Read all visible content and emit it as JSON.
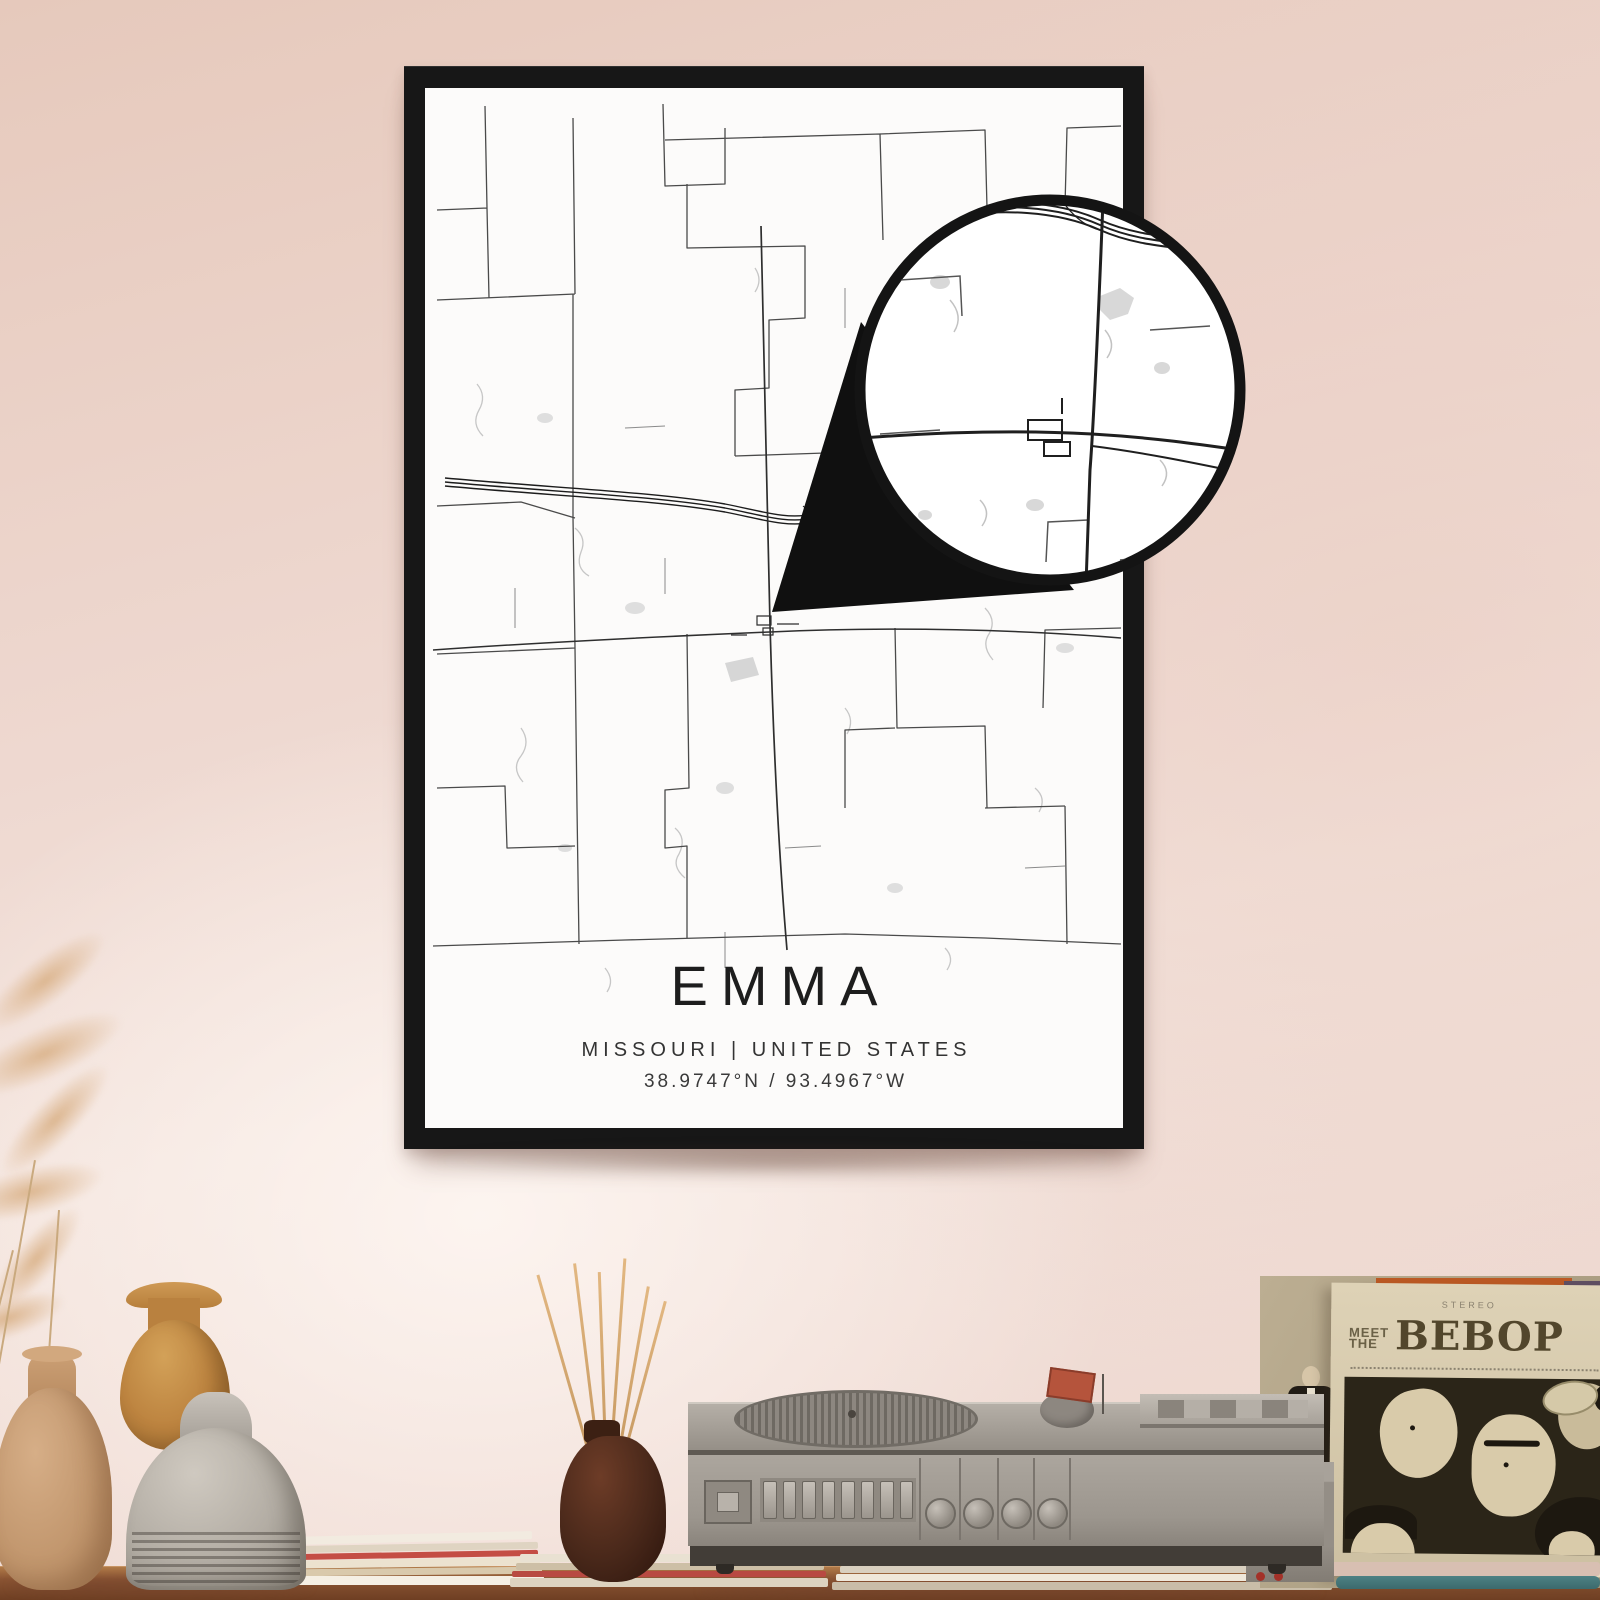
{
  "poster": {
    "title": "EMMA",
    "subtitle": "MISSOURI | UNITED STATES",
    "coordinates": "38.9747°N / 93.4967°W"
  },
  "record_sleeve": {
    "top_caption": "STEREO",
    "pretitle_line1": "MEET",
    "pretitle_line2": "THE",
    "title": "BEBOP"
  },
  "colors": {
    "wall_pink": "#eed8d0",
    "frame_black": "#171717",
    "paper_white": "#fcfbfa",
    "road_dark": "#1c1c1c",
    "road_gray": "#4a4a4a",
    "creek_gray": "#c6c6c6",
    "table_wood": "#8a5433",
    "vase_tan": "#c2976e",
    "vase_orange": "#bd8440",
    "vase_gray": "#b3ada4",
    "diffuser_brown": "#49281a",
    "player_gray": "#9c968e",
    "sleeve_cream": "#d7caac",
    "sleeve_art_dark": "#2b2518",
    "accent_red": "#b5543c"
  }
}
